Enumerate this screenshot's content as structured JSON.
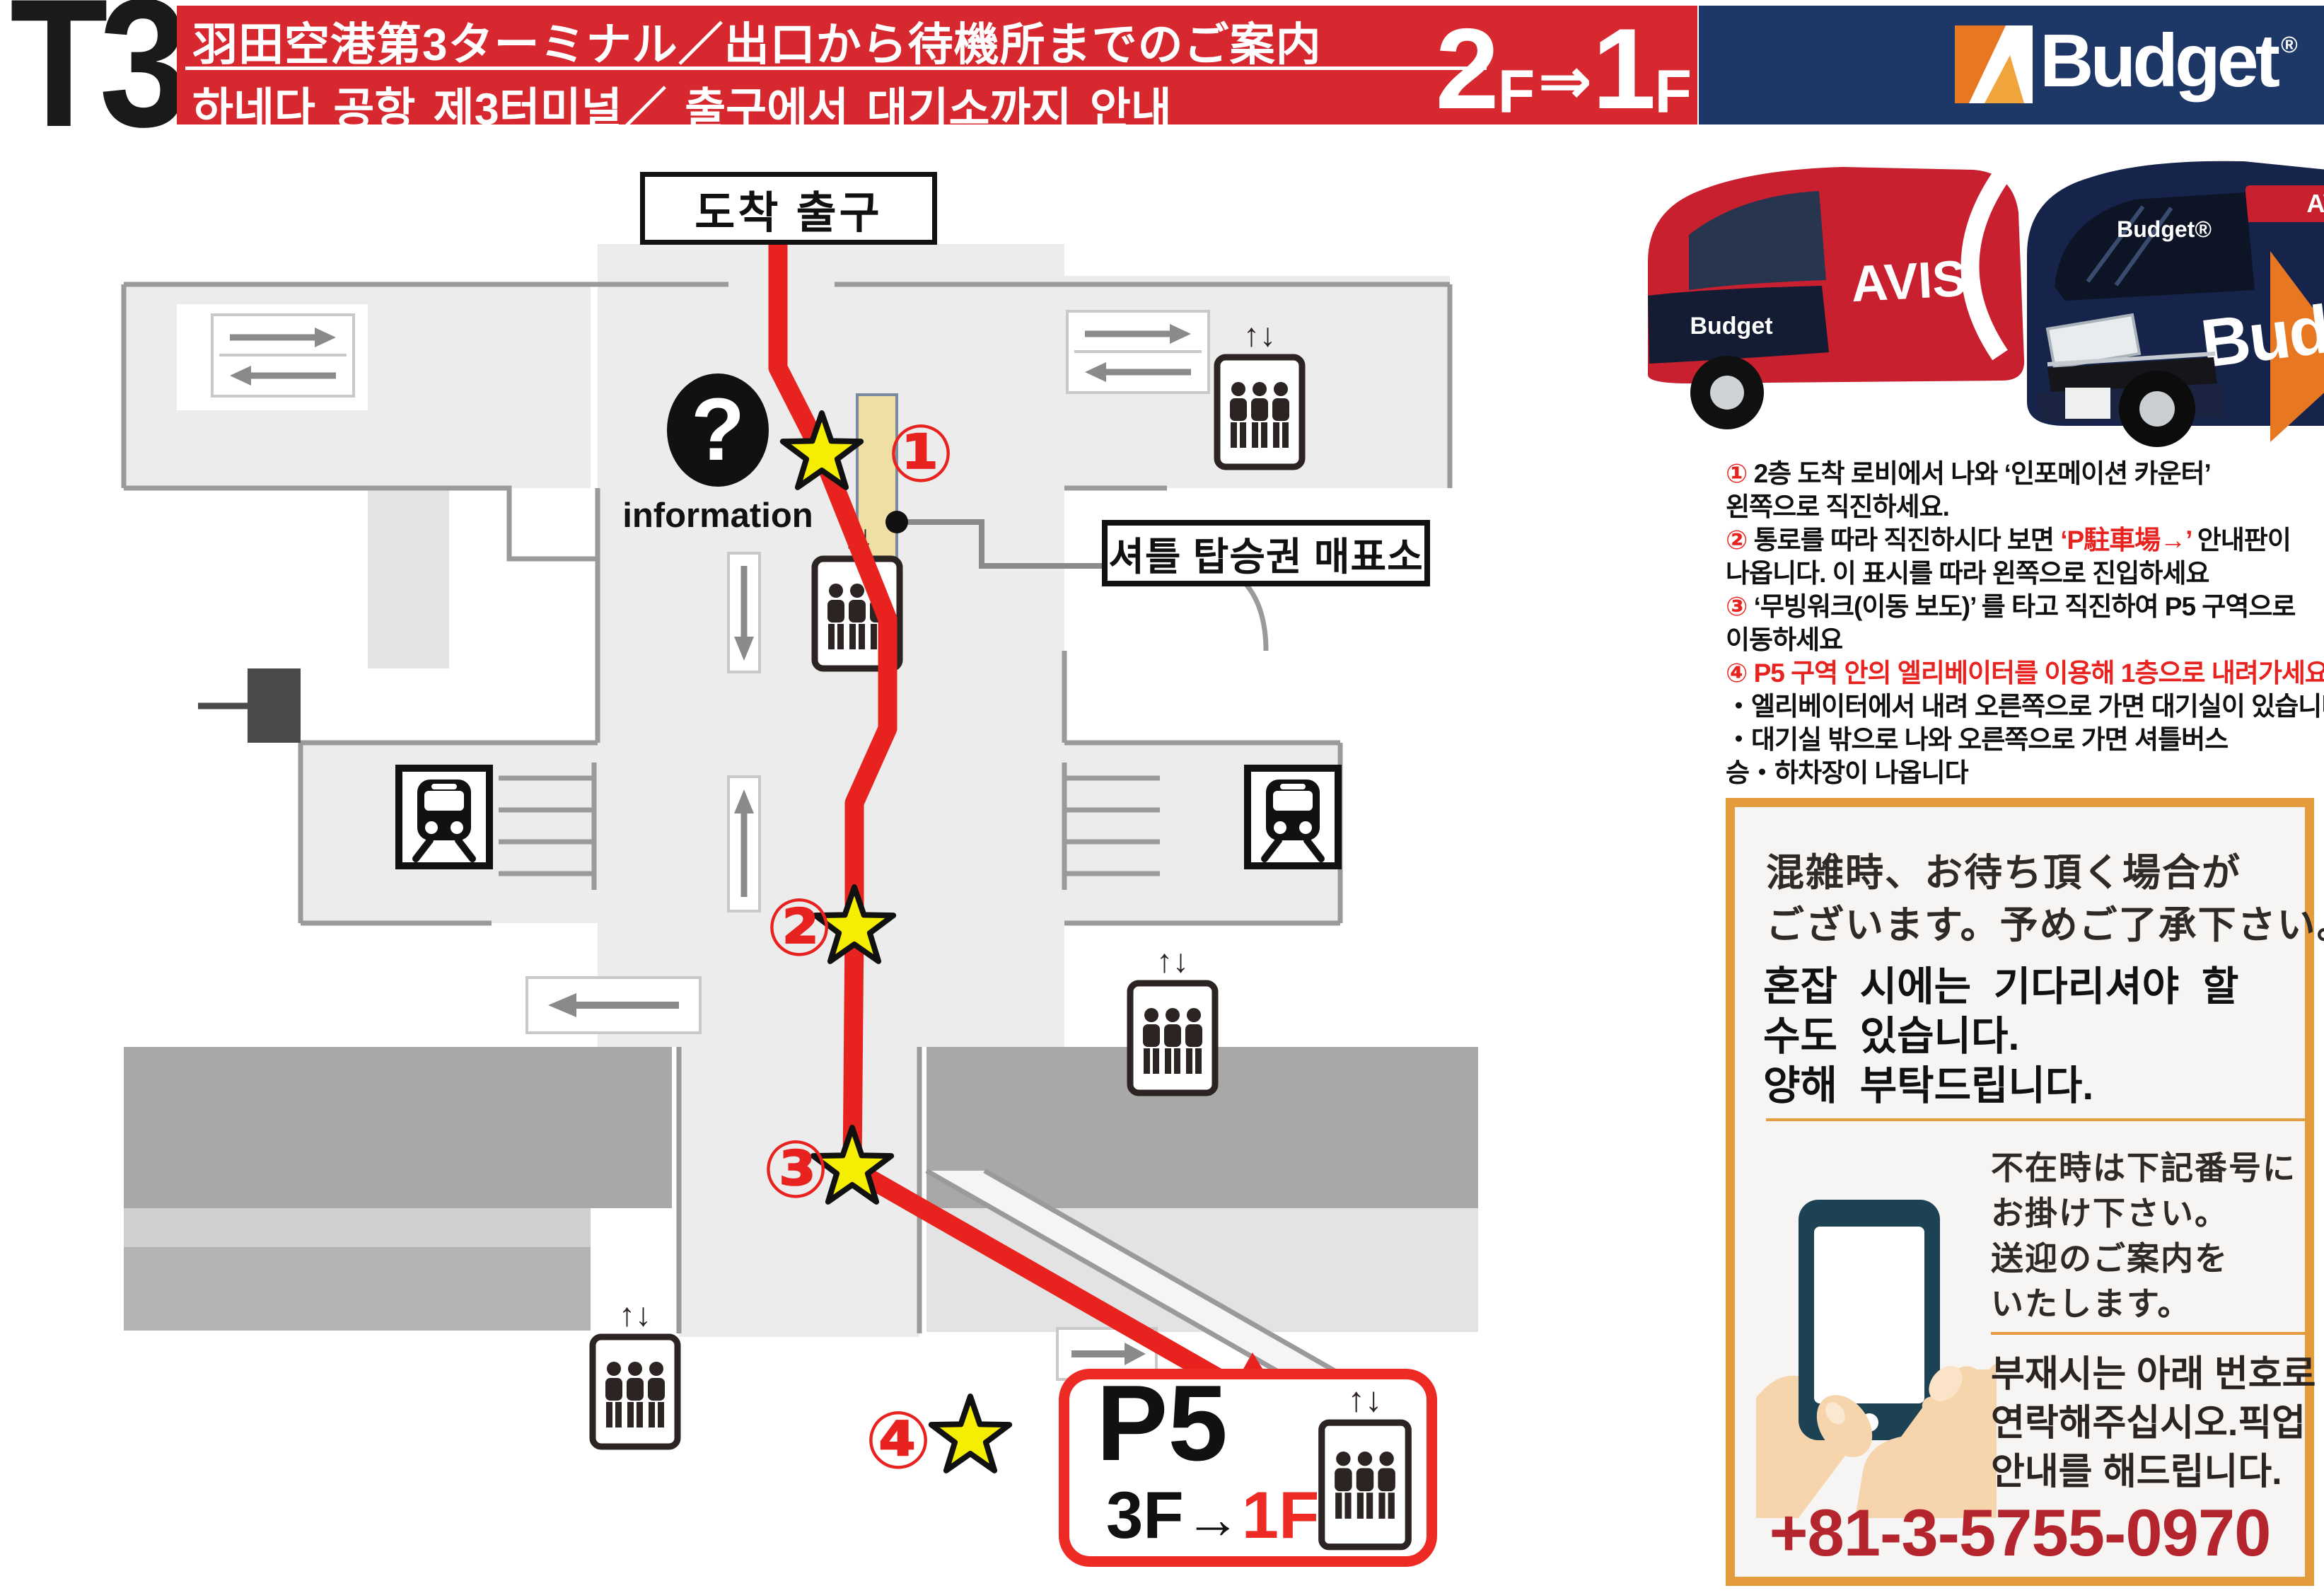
{
  "header": {
    "terminal": "T3",
    "title_ja": "羽田空港第3ターミナル／出口から待機所までのご案内",
    "title_ko": "하네다 공항 제3터미널／ 출구에서 대기소까지 안내",
    "floor": {
      "from_num": "2",
      "from_f": "F",
      "arrow": "⇒",
      "to_num": "1",
      "to_f": "F"
    },
    "brand": {
      "name": "Budget",
      "reg": "®"
    }
  },
  "vans": {
    "avis_label": "AVIS",
    "budget_label": "Budget",
    "red_van_front_label": "Budget",
    "navy_van_top_label": "AVIS",
    "navy_van_glass_label": "Budget®"
  },
  "map": {
    "exit_label": "도착 출구",
    "info": {
      "qmark": "?",
      "label": "information"
    },
    "ticket_office_label": "셔틀 탑승권 매표소",
    "elevator_arrows": "↑↓",
    "markers": [
      {
        "num": "①"
      },
      {
        "num": "②"
      },
      {
        "num": "③"
      },
      {
        "num": "④"
      }
    ],
    "p5": {
      "title": "P5",
      "from": "3F",
      "arrow": "→",
      "to": "1F"
    }
  },
  "instructions": {
    "l1_num": "①",
    "l1": " 2층 도착 로비에서 나와 ‘인포메이션 카운터’",
    "l2": "왼쪽으로 직진하세요.",
    "l3_num": "②",
    "l3a": " 통로를 따라 직진하시다 보면 ",
    "l3_red": "‘P駐車場→’",
    "l3b": " 안내판이",
    "l4": "나옵니다. 이 표시를 따라 왼쪽으로 진입하세요",
    "l5_num": "③",
    "l5": " ‘무빙워크(이동 보도)’ 를 타고 직진하여 P5 구역으로",
    "l6": "이동하세요",
    "l7_num": "④",
    "l7": " P5 구역 안의 엘리베이터를 이용해 1층으로 내려가세요",
    "l8": "・엘리베이터에서 내려 오른쪽으로 가면 대기실이 있습니다",
    "l9": "・대기실 밖으로 나와 오른쪽으로 가면 셔틀버스",
    "l10": "승・하차장이 나옵니다"
  },
  "notice": {
    "ja1": "混雑時、お待ち頂く場合が",
    "ja2": "ございます。予めご了承下さい。",
    "ko1": "혼잡 시에는 기다리셔야 할",
    "ko2": "수도 있습니다.",
    "ko3": "양해 부탁드립니다."
  },
  "contact": {
    "ja1": "不在時は下記番号に",
    "ja2": "お掛け下さい。",
    "ja3": "送迎のご案内を",
    "ja4": "いたします。",
    "ko1": "부재시는 아래 번호로",
    "ko2": "연락해주십시오.픽업",
    "ko3": "안내를 해드립니다.",
    "phone": "+81-3-5755-0970"
  },
  "colors": {
    "banner_red": "#d7282f",
    "banner_navy": "#1d3766",
    "route_red": "#e8231f",
    "accent_orange": "#e39b3c",
    "phone_red": "#b5252e",
    "star_yellow": "#f6ee00",
    "kiosk_tan": "#f0dfa4"
  }
}
